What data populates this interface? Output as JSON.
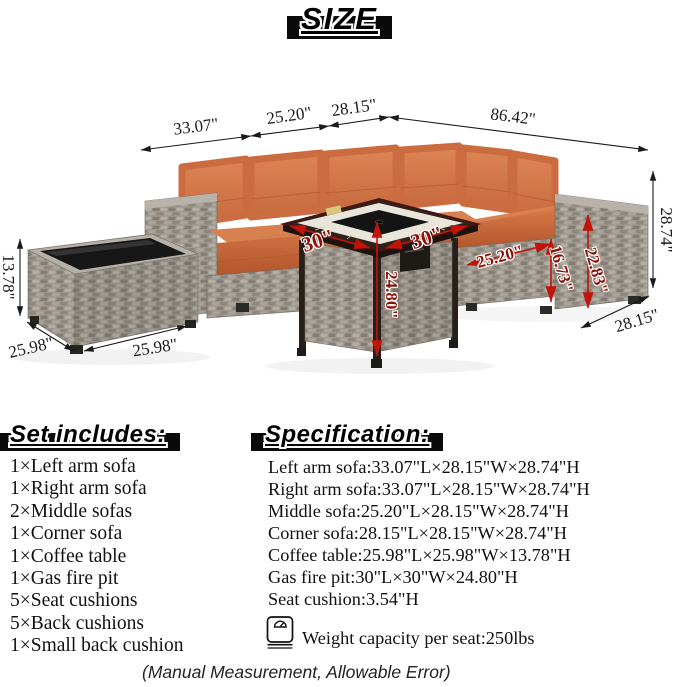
{
  "title": "SIZE",
  "dimensions": {
    "left_arm_width": "33.07\"",
    "middle_sofa_width": "25.20\"",
    "corner_width": "28.15\"",
    "right_run_width": "86.42\"",
    "sofa_height": "28.74\"",
    "sofa_depth": "28.15\"",
    "table_height": "13.78\"",
    "table_side": "25.98\"",
    "table_front": "25.98\"",
    "firepit_left": "30\"",
    "firepit_right": "30\"",
    "firepit_height": "24.80\"",
    "seat_depth": "25.20\"",
    "seat_height": "16.73\"",
    "arm_height": "22.83\""
  },
  "set_includes": {
    "heading": "Set includes:",
    "items": [
      "1×Left arm sofa",
      "1×Right arm sofa",
      "2×Middle sofas",
      "1×Corner sofa",
      "1×Coffee table",
      "1×Gas fire pit",
      "5×Seat cushions",
      "5×Back cushions",
      "1×Small back cushion"
    ]
  },
  "specification": {
    "heading": "Specification:",
    "lines": [
      "Left arm sofa:33.07\"L×28.15\"W×28.74\"H",
      "Right arm sofa:33.07\"L×28.15\"W×28.74\"H",
      "Middle sofa:25.20\"L×28.15\"W×28.74\"H",
      "Corner sofa:28.15\"L×28.15\"W×28.74\"H",
      "Coffee table:25.98\"L×25.98\"W×13.78\"H",
      "Gas fire pit:30\"L×30\"W×24.80\"H",
      "Seat cushion:3.54\"H"
    ],
    "weight_icon": "kitchen-scale-icon",
    "weight_note": "Weight capacity per seat:250lbs"
  },
  "footer_note": "(Manual Measurement, Allowable Error)",
  "colors": {
    "cushion_orange": "#c96a3e",
    "wicker_gray": "#9d978e",
    "dim_red": "#8a1208",
    "dim_black": "#1a1a1a"
  }
}
